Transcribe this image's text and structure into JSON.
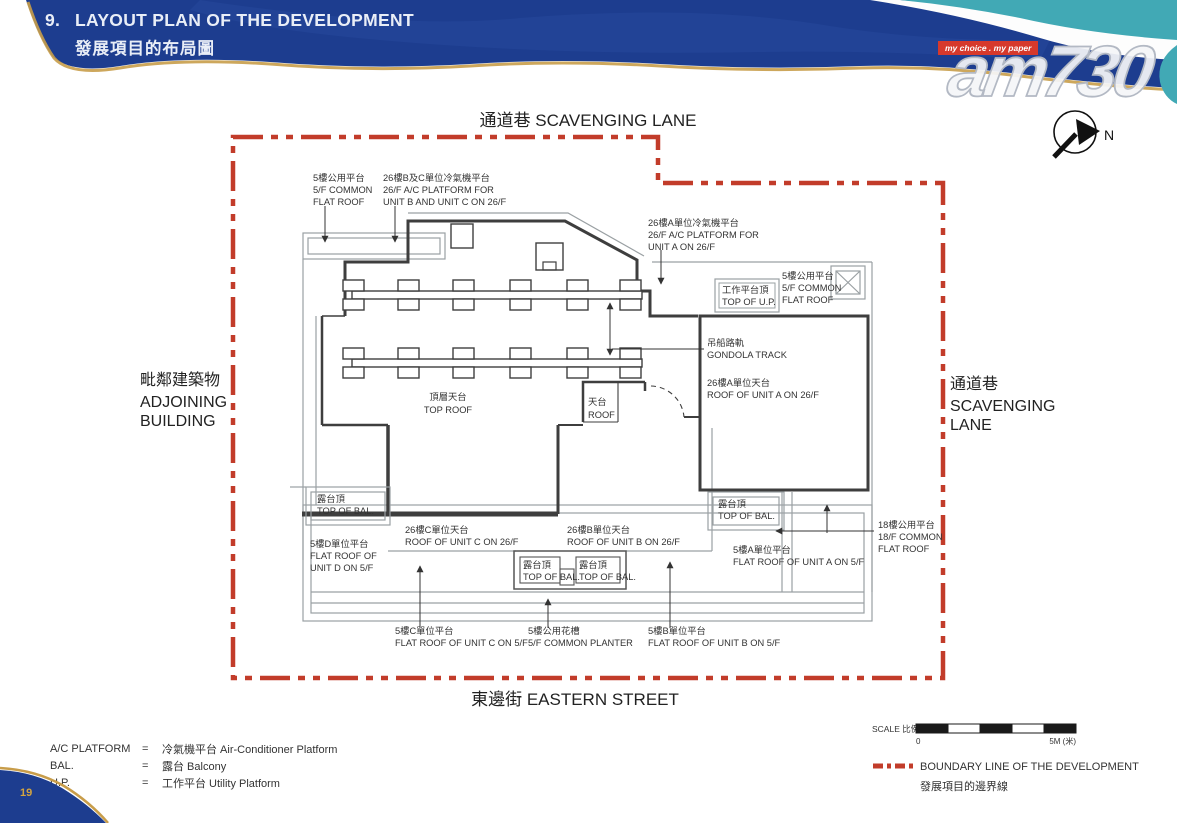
{
  "header": {
    "number": "9.",
    "title_en": "LAYOUT PLAN OF THE DEVELOPMENT",
    "title_zh": "發展項目的布局圖"
  },
  "logo": {
    "tagline": "my choice . my paper",
    "brand": "am730"
  },
  "compass": {
    "n": "N"
  },
  "streets": {
    "top": "通道巷 SCAVENGING LANE",
    "bottom": "東邊街 EASTERN STREET",
    "left": [
      "毗鄰建築物",
      "ADJOINING",
      "BUILDING"
    ],
    "right": [
      "通道巷",
      "SCAVENGING",
      "LANE"
    ]
  },
  "labels": {
    "cf5_left": [
      "5樓公用平台",
      "5/F COMMON",
      "FLAT ROOF"
    ],
    "ac_bc": [
      "26樓B及C單位冷氣機平台",
      "26/F A/C PLATFORM FOR",
      "UNIT B AND UNIT C ON 26/F"
    ],
    "ac_a": [
      "26樓A單位冷氣機平台",
      "26/F A/C PLATFORM FOR",
      "UNIT A ON 26/F"
    ],
    "top_up": [
      "工作平台頂",
      "TOP OF U.P."
    ],
    "cf5_right": [
      "5樓公用平台",
      "5/F COMMON",
      "FLAT ROOF"
    ],
    "gondola": [
      "吊船路軌",
      "GONDOLA TRACK"
    ],
    "roof_a": [
      "26樓A單位天台",
      "ROOF OF UNIT A ON 26/F"
    ],
    "top_roof": [
      "頂層天台",
      "TOP ROOF"
    ],
    "roof": [
      "天台",
      "ROOF"
    ],
    "tob_left": [
      "露台頂",
      "TOP OF BAL."
    ],
    "fr_d": [
      "5樓D單位平台",
      "FLAT ROOF OF",
      "UNIT D ON 5/F"
    ],
    "roof_c": [
      "26樓C單位天台",
      "ROOF OF UNIT C ON 26/F"
    ],
    "roof_b": [
      "26樓B單位天台",
      "ROOF OF UNIT B ON 26/F"
    ],
    "tob_right": [
      "露台頂",
      "TOP OF BAL."
    ],
    "fr_a": [
      "5樓A單位平台",
      "FLAT ROOF OF UNIT A ON 5/F"
    ],
    "tob_b1": [
      "露台頂",
      "TOP OF BAL."
    ],
    "tob_b2": [
      "露台頂",
      "TOP OF BAL."
    ],
    "cf18": [
      "18樓公用平台",
      "18/F COMMON",
      "FLAT ROOF"
    ],
    "fr_c": [
      "5樓C單位平台",
      "FLAT ROOF OF UNIT C ON 5/F"
    ],
    "planter": [
      "5樓公用花槽",
      "5/F COMMON PLANTER"
    ],
    "fr_b": [
      "5樓B單位平台",
      "FLAT ROOF OF UNIT B ON 5/F"
    ]
  },
  "legend": {
    "rows": [
      {
        "abbr": "A/C PLATFORM",
        "eq": "=",
        "full": "冷氣機平台 Air-Conditioner Platform"
      },
      {
        "abbr": "BAL.",
        "eq": "=",
        "full": "露台 Balcony"
      },
      {
        "abbr": "U.P.",
        "eq": "=",
        "full": "工作平台 Utility Platform"
      }
    ]
  },
  "scale": {
    "label": "SCALE 比例 :",
    "zero": "0",
    "max": "5M (米)"
  },
  "boundary": {
    "line1": "BOUNDARY LINE OF THE DEVELOPMENT",
    "line2": "發展項目的邊界線"
  },
  "page": {
    "number": "19"
  },
  "colors": {
    "boundary_red": "#c23c2a",
    "navy": "#1d3d8f",
    "teal": "#41a9b5",
    "gold": "#c89d4a"
  }
}
